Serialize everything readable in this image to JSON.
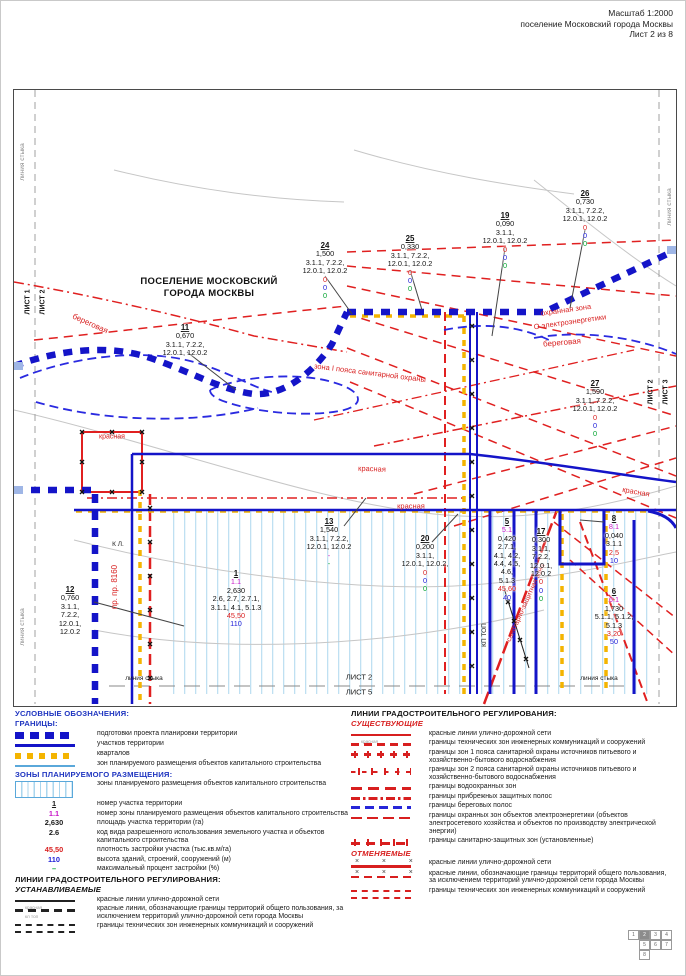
{
  "header": {
    "line1": "Масштаб 1:2000",
    "line2": "поселение Московский города Москвы",
    "line3": "Лист 2 из 8"
  },
  "map": {
    "title_line1": "ПОСЕЛЕНИЕ МОСКОВСКИЙ",
    "title_line2": "ГОРОДА МОСКВЫ",
    "labels": [
      {
        "t": "линия стыка",
        "x": 9,
        "y": 72,
        "r": -90,
        "c": "gray",
        "s": 6.5
      },
      {
        "t": "линия стыка",
        "x": 9,
        "y": 537,
        "r": -90,
        "c": "gray",
        "s": 6.5
      },
      {
        "t": "линия стыка",
        "x": 656,
        "y": 117,
        "r": -90,
        "c": "gray",
        "s": 6.5
      },
      {
        "t": "ЛИСТ 1",
        "x": 14,
        "y": 212,
        "r": -90,
        "c": "black",
        "s": 7,
        "b": 1
      },
      {
        "t": "ЛИСТ 2",
        "x": 29,
        "y": 212,
        "r": -90,
        "c": "black",
        "s": 7,
        "b": 1
      },
      {
        "t": "ЛИСТ 2",
        "x": 637,
        "y": 302,
        "r": -90,
        "c": "black",
        "s": 7,
        "b": 1
      },
      {
        "t": "ЛИСТ 3",
        "x": 652,
        "y": 302,
        "r": -90,
        "c": "black",
        "s": 7,
        "b": 1
      },
      {
        "t": "береговая",
        "x": 76,
        "y": 234,
        "r": 24,
        "c": "red",
        "s": 8
      },
      {
        "t": "красная",
        "x": 98,
        "y": 347,
        "r": 0,
        "c": "red",
        "s": 7
      },
      {
        "t": "зона I пояса санитарной охраны",
        "x": 356,
        "y": 283,
        "r": 7,
        "c": "red",
        "s": 7.5
      },
      {
        "t": "охранная зона",
        "x": 552,
        "y": 220,
        "r": -8,
        "c": "red",
        "s": 7.5
      },
      {
        "t": "О электроэнергетики",
        "x": 556,
        "y": 232,
        "r": -8,
        "c": "red",
        "s": 7.5
      },
      {
        "t": "береговая",
        "x": 548,
        "y": 253,
        "r": -5,
        "c": "red",
        "s": 8
      },
      {
        "t": "красная",
        "x": 358,
        "y": 379,
        "r": 2,
        "c": "red",
        "s": 7.5
      },
      {
        "t": "красная",
        "x": 397,
        "y": 416,
        "r": 0,
        "c": "red",
        "s": 7.5
      },
      {
        "t": "красная",
        "x": 622,
        "y": 402,
        "r": 10,
        "c": "red",
        "s": 7.5
      },
      {
        "t": "санитарно-защитная зона",
        "x": 512,
        "y": 513,
        "r": -66,
        "c": "red",
        "s": 7
      },
      {
        "t": "пр. пр. 8160",
        "x": 101,
        "y": 497,
        "r": -90,
        "c": "red",
        "s": 8
      },
      {
        "t": "К Л.",
        "x": 104,
        "y": 455,
        "r": 0,
        "c": "black",
        "s": 6.5
      },
      {
        "t": "КП ТОП",
        "x": 471,
        "y": 545,
        "r": -90,
        "c": "black",
        "s": 6.5
      },
      {
        "t": "линия стыка",
        "x": 130,
        "y": 589,
        "r": 0,
        "c": "black",
        "s": 6.5
      },
      {
        "t": "ЛИСТ 2",
        "x": 345,
        "y": 587,
        "r": 0,
        "c": "black",
        "s": 7.5
      },
      {
        "t": "ЛИСТ 5",
        "x": 345,
        "y": 602,
        "r": 0,
        "c": "black",
        "s": 7.5
      },
      {
        "t": "линия стыка",
        "x": 585,
        "y": 589,
        "r": 0,
        "c": "black",
        "s": 6.5
      }
    ],
    "parcels": [
      {
        "num": "11",
        "lines": [
          "0,670",
          "3.1.1, 7.2.2,",
          "12.0.1, 12.0.2"
        ],
        "x": 171,
        "y": 234
      },
      {
        "num": "24",
        "lines": [
          "1,500",
          "3.1.1, 7.2.2,",
          "12.0.1, 12.0.2"
        ],
        "extras": [
          [
            "0",
            "red"
          ],
          [
            "0",
            "blue"
          ],
          [
            "0",
            "green"
          ]
        ],
        "x": 311,
        "y": 152
      },
      {
        "num": "25",
        "lines": [
          "0,330",
          "3.1.1, 7.2.2,",
          "12.0.1, 12.0.2"
        ],
        "extras": [
          [
            "0",
            "red"
          ],
          [
            "0",
            "blue"
          ],
          [
            "0",
            "green"
          ]
        ],
        "x": 396,
        "y": 145
      },
      {
        "num": "19",
        "lines": [
          "0,090",
          "3.1.1,",
          "12.0.1, 12.0.2"
        ],
        "extras": [
          [
            "0",
            "red"
          ],
          [
            "0",
            "blue"
          ],
          [
            "0",
            "green"
          ]
        ],
        "x": 491,
        "y": 122
      },
      {
        "num": "26",
        "lines": [
          "0,730",
          "3.1.1, 7.2.2,",
          "12.0.1, 12.0.2"
        ],
        "extras": [
          [
            "0",
            "red"
          ],
          [
            "0",
            "blue"
          ],
          [
            "0",
            "green"
          ]
        ],
        "x": 571,
        "y": 100
      },
      {
        "num": "27",
        "lines": [
          "1,590",
          "3.1.1, 7.2.2,",
          "12.0.1, 12.0.2"
        ],
        "extras": [
          [
            "0",
            "red"
          ],
          [
            "0",
            "blue"
          ],
          [
            "0",
            "green"
          ]
        ],
        "x": 581,
        "y": 290
      },
      {
        "num": "13",
        "lines": [
          "1,540",
          "3.1.1, 7.2.2,",
          "12.0.1, 12.0.2"
        ],
        "extras": [
          [
            "-",
            "magenta"
          ],
          [
            "-",
            "green"
          ]
        ],
        "x": 315,
        "y": 428
      },
      {
        "num": "20",
        "lines": [
          "0,200",
          "3.1.1,",
          "12.0.1, 12.0.2,"
        ],
        "extras": [
          [
            "0",
            "red"
          ],
          [
            "0",
            "blue"
          ],
          [
            "0",
            "green"
          ]
        ],
        "x": 411,
        "y": 445
      },
      {
        "num": "5",
        "pre": "5.1",
        "lines": [
          "0,420",
          "2.7.1,",
          "4.1, 4.2,",
          "4.4, 4.5,",
          "4.6,",
          "5.1.3"
        ],
        "extras": [
          [
            "45,60",
            "red"
          ],
          [
            "40",
            "blue"
          ]
        ],
        "x": 493,
        "y": 428
      },
      {
        "num": "17",
        "lines": [
          "0,300",
          "3.1.1,",
          "7.2.2,",
          "12.0.1,",
          "12.0.2"
        ],
        "extras": [
          [
            "0",
            "red"
          ],
          [
            "0",
            "blue"
          ],
          [
            "0",
            "green"
          ]
        ],
        "x": 527,
        "y": 438
      },
      {
        "num": "8",
        "pre": "8.1",
        "lines": [
          "0,040",
          "3.1.1"
        ],
        "extras": [
          [
            "2,5",
            "red"
          ],
          [
            "10",
            "blue"
          ]
        ],
        "x": 600,
        "y": 425
      },
      {
        "num": "6",
        "pre": "6.1",
        "lines": [
          "1,730",
          "5.1.1, 5.1.2,",
          "5.1.3"
        ],
        "extras": [
          [
            "3,20",
            "red"
          ],
          [
            "50",
            "blue"
          ]
        ],
        "x": 600,
        "y": 498
      },
      {
        "num": "12",
        "lines": [
          "0,760",
          "3.1.1,",
          "7.2.2,",
          "12.0.1,",
          "12.0.2"
        ],
        "x": 56,
        "y": 496
      },
      {
        "num": "1",
        "pre": "1.1",
        "lines": [
          "2,630",
          "2.6, 2.7, 2.7.1,",
          "3.1.1, 4.1, 5.1.3"
        ],
        "extras": [
          [
            "45,50",
            "red"
          ],
          [
            "110",
            "blue"
          ]
        ],
        "x": 222,
        "y": 480
      }
    ]
  },
  "legend": {
    "left": [
      {
        "h": "УСЛОВНЫЕ ОБОЗНАЧЕНИЯ:",
        "c": "blue"
      },
      {
        "h": "ГРАНИЦЫ:",
        "c": "blue"
      },
      {
        "sw": "blue-chain",
        "t": "подготовки проекта планировки территории"
      },
      {
        "sw": "blue-solid",
        "t": "участков территории"
      },
      {
        "sw": "yellow",
        "t": "кварталов"
      },
      {
        "sw": "cyan",
        "t": "зон планируемого размещения объектов капитального строительства"
      },
      {
        "h": "ЗОНЫ ПЛАНИРУЕМОГО РАЗМЕЩЕНИЯ:",
        "c": "blue"
      },
      {
        "sw": "hatchbox",
        "t": "зоны планируемого размещения объектов капитального строительства"
      },
      {
        "sym": "1",
        "symc": "black",
        "u": 1,
        "t": "номер участка территории"
      },
      {
        "sym": "1.1",
        "symc": "magenta",
        "t": "номер зоны планируемого размещения объектов капитального строительства"
      },
      {
        "sym": "2,630",
        "symc": "black",
        "t": "площадь участка территории (га)"
      },
      {
        "sym": "2.6",
        "symc": "black",
        "t": "код вида разрешенного использования земельного участка и объектов капитального строительства"
      },
      {
        "sym": "45,50",
        "symc": "red",
        "t": "плотность застройки участка (тыс.кв.м/га)"
      },
      {
        "sym": "110",
        "symc": "blue",
        "t": "высота зданий, строений, сооружений (м)"
      },
      {
        "sym": "–",
        "symc": "green",
        "t": "максимальный процент застройки (%)"
      },
      {
        "h": "ЛИНИИ ГРАДОСТРОИТЕЛЬНОГО РЕГУЛИРОВАНИЯ:",
        "c": "black"
      },
      {
        "h": "УСТАНАВЛИВАЕМЫЕ",
        "c": "black",
        "i": 1
      },
      {
        "sw": "black-solid",
        "sub": "красная",
        "t": "красные линии улично-дорожной сети"
      },
      {
        "sw": "black-dash",
        "sub": "кл топ",
        "t": "красные линии, обозначающие границы территорий общего пользования, за исключением территорий улично-дорожной сети города Москвы"
      },
      {
        "sw": "black-dbl",
        "t": "границы технических зон инженерных коммуникаций и сооружений"
      }
    ],
    "right": [
      {
        "h": "ЛИНИИ ГРАДОСТРОИТЕЛЬНОГО РЕГУЛИРОВАНИЯ:",
        "c": "black"
      },
      {
        "h": "СУЩЕСТВУЮЩИЕ",
        "c": "red",
        "i": 1
      },
      {
        "sw": "red-solid",
        "sub": "красная",
        "t": "красные линии улично-дорожной сети"
      },
      {
        "sw": "red-dash",
        "t": "границы технических зон инженерных коммуникаций и сооружений"
      },
      {
        "sw": "red-zone",
        "t": "границы зон 1 пояса санитарной охраны источников питьевого и хозяйственно-бытового водоснабжения"
      },
      {
        "sw": "red-zone2",
        "t": "границы зон 2 пояса санитарной охраны источников питьевого и хозяйственно-бытового водоснабжения"
      },
      {
        "sw": "red-wdash",
        "t": "границы водоохранных зон"
      },
      {
        "sw": "red-dashdot",
        "t": "границы прибрежных защитных полос"
      },
      {
        "sw": "blue-dash",
        "t": "границы береговых полос"
      },
      {
        "sw": "red-eldash",
        "t": "границы охранных зон объектов электроэнергетики (объектов электросетевого хозяйства и объектов по производству электрической энергии)"
      },
      {
        "sw": "red-szdash",
        "t": "границы санитарно-защитных зон (установленные)"
      },
      {
        "h": "ОТМЕНЯЕМЫЕ",
        "c": "red",
        "i": 1
      },
      {
        "sw": "red-solid-x",
        "t": "красные линии улично-дорожной сети"
      },
      {
        "sw": "red-dash-x",
        "t": "красные линии, обозначающие границы территорий общего пользования, за исключением территорий улично-дорожной сети города Москвы"
      },
      {
        "sw": "red-dbl",
        "t": "границы технических зон инженерных коммуникаций и сооружений"
      }
    ]
  },
  "sheet_grid": {
    "rows": [
      [
        "1",
        "2",
        "3",
        "4"
      ],
      [
        "",
        "5",
        "6",
        "7"
      ],
      [
        "",
        "8"
      ]
    ],
    "active": "2"
  },
  "colors": {
    "map_blue": "#1414c8",
    "map_red": "#d81f1f",
    "quarter_yellow": "#f4b400",
    "zone_cyan": "#aad6ee",
    "value_blue": "#2020d8",
    "value_green": "#00a32e",
    "value_magenta": "#c818c8"
  }
}
